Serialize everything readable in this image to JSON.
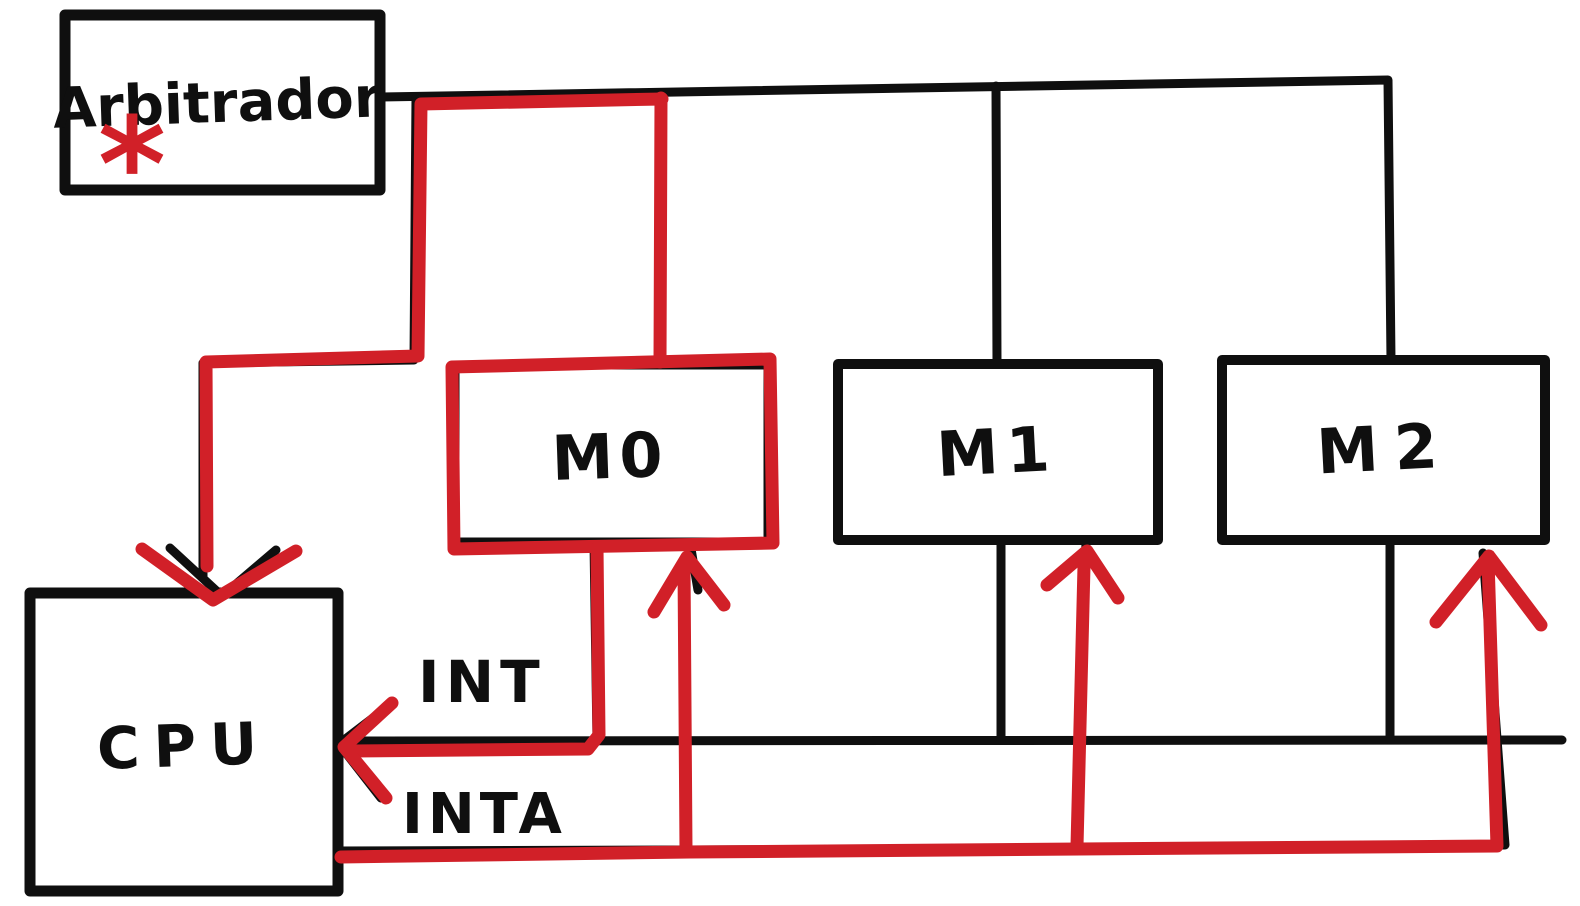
{
  "diagram": {
    "kind": "hand-drawn interrupt / bus arbitration sketch",
    "nodes": {
      "arbiter": {
        "label": "Arbitrador",
        "asterisk": "*"
      },
      "m0": {
        "label": "M0"
      },
      "m1": {
        "label": "M1"
      },
      "m2": {
        "label": "M2"
      },
      "cpu": {
        "label": "CPU"
      }
    },
    "signals": {
      "int": {
        "label": "INT"
      },
      "inta": {
        "label": "INTA"
      }
    },
    "colors": {
      "ink": "#0f0f0f",
      "highlight": "#d12028",
      "background": "#ffffff"
    }
  }
}
